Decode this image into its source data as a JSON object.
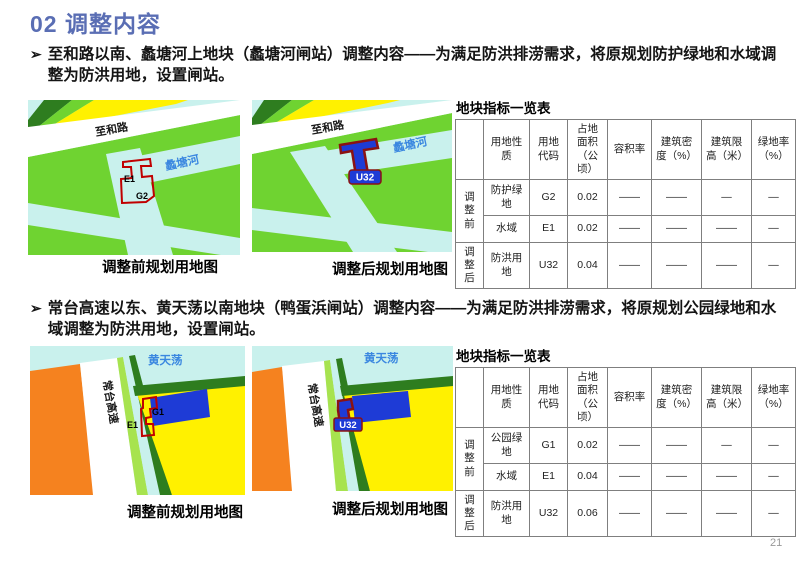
{
  "page": {
    "title": "02 调整内容",
    "page_number": "21",
    "bullet_marker": "➢"
  },
  "colors": {
    "title_blue": "#5A6EB4",
    "map_green": "#6FD331",
    "map_light_cyan": "#C9F1ED",
    "map_yellow": "#FFF100",
    "map_dark_green": "#2E7D1F",
    "map_orange": "#F5821F",
    "parcel_blue_fill": "#1E3BD6",
    "parcel_red_outline": "#C00000",
    "parcel_maroon_outline": "#8B1212",
    "water_label_blue": "#3A87E0"
  },
  "sections": [
    {
      "bullet_text": "至和路以南、蠡塘河上地块（蠡塘河闸站）调整内容——为满足防洪排涝需求，将原规划防护绿地和水域调整为防洪用地，设置闸站。",
      "map_before": {
        "caption": "调整前规划用地图",
        "road_label": "至和路",
        "water_label": "蠡塘河",
        "parcel_label_a": "E1",
        "parcel_label_b": "G2"
      },
      "map_after": {
        "caption": "调整后规划用地图",
        "road_label": "至和路",
        "water_label": "蠡塘河",
        "parcel_label": "U32"
      },
      "table": {
        "title": "地块指标一览表",
        "headers": {
          "corner": "",
          "use": "用地性质",
          "code": "用地代码",
          "area": "占地面积（公顷）",
          "far": "容积率",
          "density": "建筑密度（%）",
          "height": "建筑限高（米）",
          "green": "绿地率（%）"
        },
        "groups": [
          {
            "label": "调整前",
            "rows": [
              {
                "use": "防护绿地",
                "code": "G2",
                "area": "0.02",
                "far": "——",
                "density": "——",
                "height": "—",
                "green": "—"
              },
              {
                "use": "水域",
                "code": "E1",
                "area": "0.02",
                "far": "——",
                "density": "——",
                "height": "——",
                "green": "—"
              }
            ]
          },
          {
            "label": "调整后",
            "rows": [
              {
                "use": "防洪用地",
                "code": "U32",
                "area": "0.04",
                "far": "——",
                "density": "——",
                "height": "——",
                "green": "—"
              }
            ]
          }
        ]
      }
    },
    {
      "bullet_text": "常台高速以东、黄天荡以南地块（鸭蛋浜闸站）调整内容——为满足防洪排涝需求，将原规划公园绿地和水域调整为防洪用地，设置闸站。",
      "map_before": {
        "caption": "调整前规划用地图",
        "road_label": "常台高速",
        "water_label": "黄天荡",
        "parcel_label_a": "E1",
        "parcel_label_b": "G1"
      },
      "map_after": {
        "caption": "调整后规划用地图",
        "road_label": "常台高速",
        "water_label": "黄天荡",
        "parcel_label": "U32"
      },
      "table": {
        "title": "地块指标一览表",
        "headers": {
          "corner": "",
          "use": "用地性质",
          "code": "用地代码",
          "area": "占地面积（公顷）",
          "far": "容积率",
          "density": "建筑密度（%）",
          "height": "建筑限高（米）",
          "green": "绿地率（%）"
        },
        "groups": [
          {
            "label": "调整前",
            "rows": [
              {
                "use": "公园绿地",
                "code": "G1",
                "area": "0.02",
                "far": "——",
                "density": "——",
                "height": "—",
                "green": "—"
              },
              {
                "use": "水域",
                "code": "E1",
                "area": "0.04",
                "far": "——",
                "density": "——",
                "height": "——",
                "green": "—"
              }
            ]
          },
          {
            "label": "调整后",
            "rows": [
              {
                "use": "防洪用地",
                "code": "U32",
                "area": "0.06",
                "far": "——",
                "density": "——",
                "height": "——",
                "green": "—"
              }
            ]
          }
        ]
      }
    }
  ]
}
